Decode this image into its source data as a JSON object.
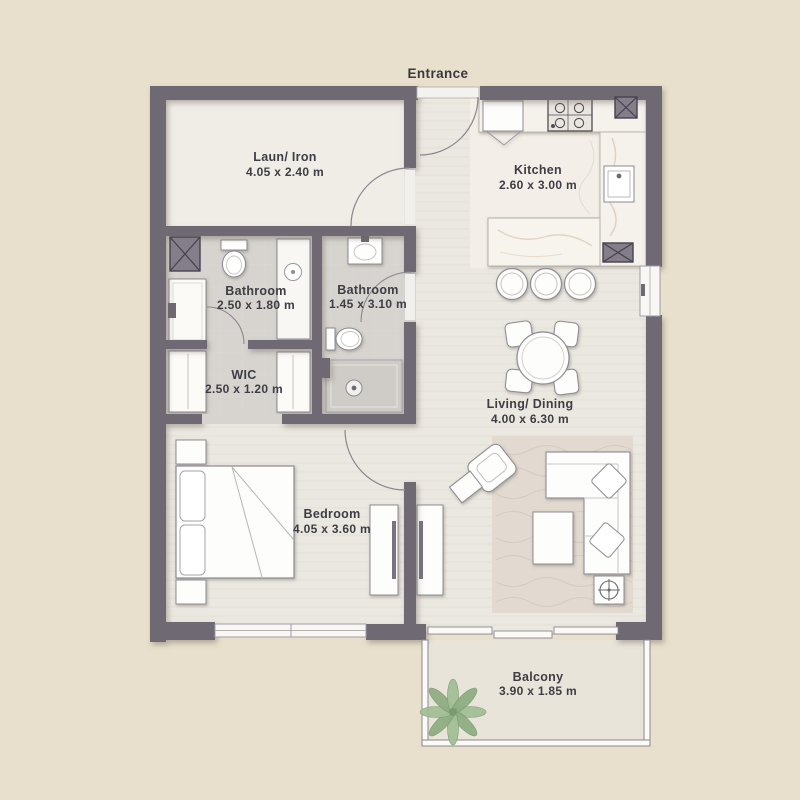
{
  "plan": {
    "entrance_label": "Entrance",
    "rooms": {
      "laundry": {
        "name": "Laun/ Iron",
        "dims": "4.05 x 2.40 m"
      },
      "kitchen": {
        "name": "Kitchen",
        "dims": "2.60 x 3.00 m"
      },
      "bathroom1": {
        "name": "Bathroom",
        "dims": "2.50 x 1.80 m"
      },
      "bathroom2": {
        "name": "Bathroom",
        "dims": "1.45 x 3.10 m"
      },
      "wic": {
        "name": "WIC",
        "dims": "2.50 x 1.20 m"
      },
      "living": {
        "name": "Living/ Dining",
        "dims": "4.00 x 6.30 m"
      },
      "bedroom": {
        "name": "Bedroom",
        "dims": "4.05 x 3.60 m"
      },
      "balcony": {
        "name": "Balcony",
        "dims": "3.90 x 1.85 m"
      }
    },
    "colors": {
      "background": "#e8e0cc",
      "wall": "#6e6973",
      "floor": "#ebe8e1",
      "bath_floor": "#d7d4cf",
      "marble": "#f3efe8",
      "rug": "#e2dad0",
      "plant_green": "#9cb892",
      "label_text": "#3e3d45"
    }
  }
}
